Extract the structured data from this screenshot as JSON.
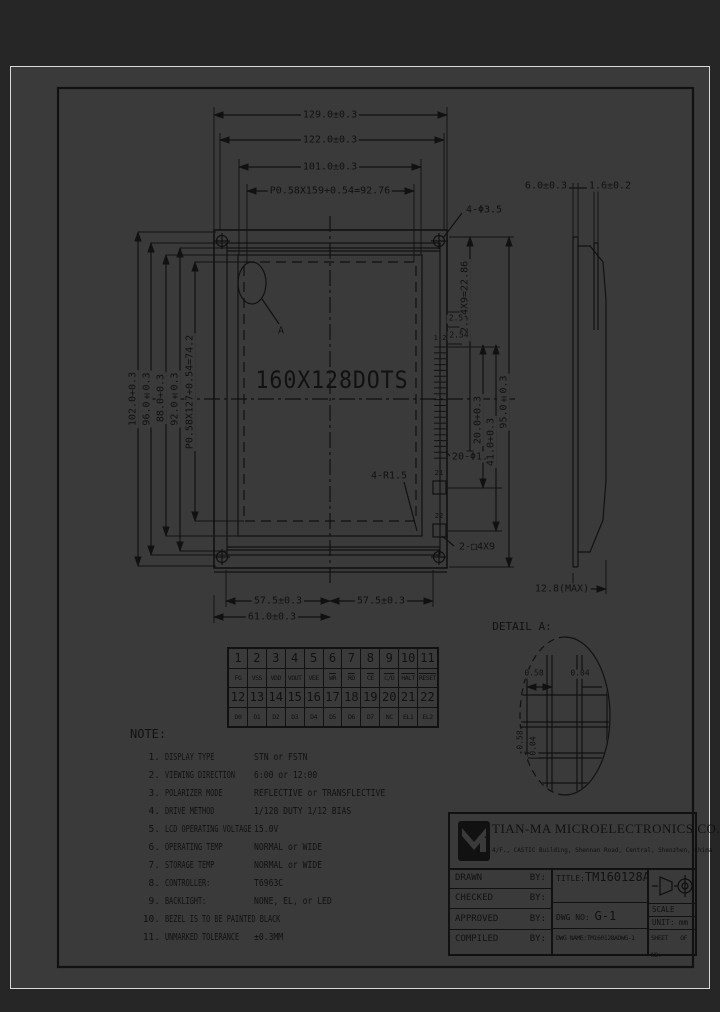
{
  "front": {
    "display": "160X128DOTS",
    "detail_marker": "A",
    "pins_top": "1 2",
    "pin21": "21",
    "pin22": "22"
  },
  "dims": {
    "w129": "129.0±0.3",
    "w122": "122.0±0.3",
    "w101": "101.0±0.3",
    "wpitch": "P0.58X159+0.54=92.76",
    "h102": "102.0+0.3",
    "h96": "96.0±0.3",
    "h88": "88.0+0.3",
    "h92": "92.0±0.3",
    "hpitch": "P0.58X127+0.54=74.2",
    "bottom_left": "57.5±0.3",
    "bottom_right": "57.5±0.3",
    "bottom_total": "61.0±0.3",
    "conn_pitch": "P2.54X9=22.86",
    "conn_2_5": "2.5",
    "conn_2_54": "2.54",
    "conn_20": "20.0+0.3",
    "conn_41": "41.0+0.3",
    "conn_95": "95.0±0.3",
    "holes": "4-Φ3.5",
    "pin_holes": "20-Φ1.0",
    "slots": "2-□4X9",
    "corner_r": "4-R1.5",
    "side_6": "6.0±0.3",
    "side_1_6": "1.6±0.2",
    "side_max": "12.8(MAX)"
  },
  "detail": {
    "title": "DETAIL A:",
    "h_pitch": "0.58",
    "h_gap": "0.04",
    "v_pitch": "0.58",
    "v_gap": "0.04"
  },
  "pin_table": {
    "row1": [
      "1",
      "2",
      "3",
      "4",
      "5",
      "6",
      "7",
      "8",
      "9",
      "10",
      "11"
    ],
    "row2": [
      "FG",
      "VSS",
      "VDD",
      "VOUT",
      "VEE",
      "WR",
      "RD",
      "CE",
      "C/D",
      "HALT",
      "RESET"
    ],
    "row3": [
      "12",
      "13",
      "14",
      "15",
      "16",
      "17",
      "18",
      "19",
      "20",
      "21",
      "22"
    ],
    "row4": [
      "D0",
      "D1",
      "D2",
      "D3",
      "D4",
      "D5",
      "D6",
      "D7",
      "NC",
      "EL1",
      "EL2"
    ]
  },
  "notes": {
    "title": "NOTE:",
    "items": [
      {
        "num": "1.",
        "label": "DISPLAY TYPE",
        "value": "STN or FSTN"
      },
      {
        "num": "2.",
        "label": "VIEWING DIRECTION",
        "value": "6:00 or 12:00"
      },
      {
        "num": "3.",
        "label": "POLARIZER MODE",
        "value": "REFLECTIVE or TRANSFLECTIVE"
      },
      {
        "num": "4.",
        "label": "DRIVE METHOD",
        "value": "1/128 DUTY 1/12 BIAS"
      },
      {
        "num": "5.",
        "label": "LCD OPERATING VOLTAGE",
        "value": "15.0V"
      },
      {
        "num": "6.",
        "label": "OPERATING TEMP",
        "value": "NORMAL or WIDE"
      },
      {
        "num": "7.",
        "label": "STORAGE TEMP",
        "value": "NORMAL or WIDE"
      },
      {
        "num": "8.",
        "label": "CONTROLLER:",
        "value": "T6963C"
      },
      {
        "num": "9.",
        "label": "BACKLIGHT:",
        "value": "NONE, EL, or LED"
      },
      {
        "num": "10.",
        "label": "BEZEL IS TO BE PAINTED BLACK",
        "value": ""
      },
      {
        "num": "11.",
        "label": "UNMARKED TOLERANCE",
        "value": "±0.3MM"
      }
    ]
  },
  "title_block": {
    "company": "TIAN-MA MICROELECTRONICS CO.",
    "address": "4/F., CASTIC Building, Shennan Road, Central, Shenzhen, China",
    "sign_rows": [
      {
        "label": "DRAWN",
        "by": "BY:"
      },
      {
        "label": "CHECKED",
        "by": "BY:"
      },
      {
        "label": "APPROVED",
        "by": "BY:"
      },
      {
        "label": "COMPILED",
        "by": "BY:"
      }
    ],
    "title_label": "TITLE:",
    "title_value": "TM160128A",
    "dwg_no_label": "DWG NO:",
    "dwg_no_value": "G-1",
    "dwg_name_label": "DWG NAME:",
    "dwg_name_value": "TM160128ADWG-1",
    "scale_label": "SCALE",
    "unit_label": "UNIT:",
    "unit_value": "mm",
    "sheet_label": "SHEET NO:",
    "sheet_value": "OF"
  },
  "colors": {
    "sheet": "#3a3a3a",
    "ink": "#111111",
    "frame": "#d9d9d9"
  }
}
